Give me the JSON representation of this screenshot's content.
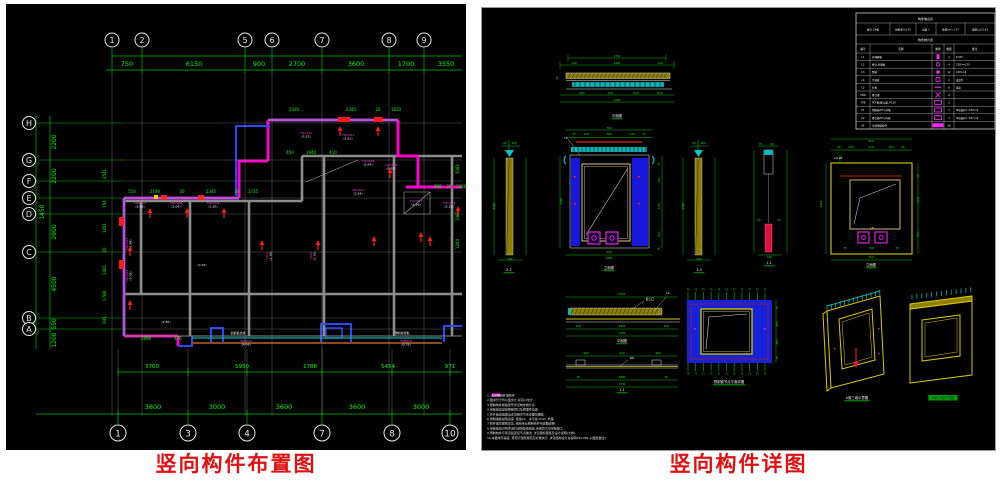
{
  "left": {
    "caption": "竖向构件布置图",
    "topGrid": [
      {
        "x": 106,
        "n": "1"
      },
      {
        "x": 136,
        "n": "2"
      },
      {
        "x": 239,
        "n": "5"
      },
      {
        "x": 266,
        "n": "6"
      },
      {
        "x": 316,
        "n": "7"
      },
      {
        "x": 383,
        "n": "8"
      },
      {
        "x": 418,
        "n": "9"
      }
    ],
    "topDims": [
      {
        "x": 121,
        "t": "750"
      },
      {
        "x": 188,
        "t": "6150"
      },
      {
        "x": 253,
        "t": "900"
      },
      {
        "x": 291,
        "t": "2700"
      },
      {
        "x": 350,
        "t": "3600"
      },
      {
        "x": 400,
        "t": "1700"
      },
      {
        "x": 440,
        "t": "3550"
      }
    ],
    "leftGrid": [
      {
        "y": 119,
        "n": "H"
      },
      {
        "y": 156,
        "n": "G"
      },
      {
        "y": 177,
        "n": "F"
      },
      {
        "y": 194,
        "n": "E"
      },
      {
        "y": 210,
        "n": "D"
      },
      {
        "y": 248,
        "n": "C"
      },
      {
        "y": 314,
        "n": "B"
      },
      {
        "y": 325,
        "n": "A"
      }
    ],
    "leftDims": [
      {
        "x": 50,
        "y": 138,
        "t": "2200"
      },
      {
        "x": 50,
        "y": 172,
        "t": "2200"
      },
      {
        "x": 50,
        "y": 228,
        "t": "2900"
      },
      {
        "x": 50,
        "y": 280,
        "t": "4500"
      },
      {
        "x": 50,
        "y": 320,
        "t": "550"
      },
      {
        "x": 50,
        "y": 336,
        "t": "1200"
      },
      {
        "x": 38,
        "y": 208,
        "t": "1450"
      }
    ],
    "botGrid": [
      {
        "x": 112,
        "n": "1"
      },
      {
        "x": 182,
        "n": "3"
      },
      {
        "x": 241,
        "n": "4"
      },
      {
        "x": 316,
        "n": "7"
      },
      {
        "x": 386,
        "n": "8"
      },
      {
        "x": 444,
        "n": "10"
      }
    ],
    "botDims": [
      {
        "x": 147,
        "t": "3600"
      },
      {
        "x": 211,
        "t": "3000"
      },
      {
        "x": 278,
        "t": "3600"
      },
      {
        "x": 351,
        "t": "3600"
      },
      {
        "x": 415,
        "t": "3000"
      }
    ],
    "midDims": [
      {
        "x": 146,
        "t": "3700"
      },
      {
        "x": 236,
        "t": "5950"
      },
      {
        "x": 304,
        "t": "1788"
      },
      {
        "x": 382,
        "t": "5454"
      },
      {
        "x": 444,
        "t": "971"
      }
    ],
    "planDims": [
      {
        "y": 189,
        "items": [
          {
            "x": 126,
            "t": "510"
          },
          {
            "x": 149,
            "t": "2190"
          },
          {
            "x": 176,
            "t": "20"
          },
          {
            "x": 205,
            "t": "2345"
          },
          {
            "x": 231,
            "t": "20"
          },
          {
            "x": 247,
            "t": "1735"
          }
        ]
      },
      {
        "y": 107,
        "items": [
          {
            "x": 288,
            "t": "2430"
          },
          {
            "x": 345,
            "t": "2340"
          },
          {
            "x": 372,
            "t": "20"
          },
          {
            "x": 390,
            "t": "1620"
          }
        ]
      },
      {
        "y": 150,
        "items": [
          {
            "x": 284,
            "t": "450"
          },
          {
            "x": 305,
            "t": "1940"
          },
          {
            "x": 327,
            "t": "410"
          }
        ]
      },
      {
        "y": 184,
        "items": [
          {
            "x": 432,
            "t": "988"
          },
          {
            "x": 443,
            "t": "20"
          },
          {
            "x": 455,
            "t": "2838"
          }
        ]
      },
      {
        "y": 336,
        "items": [
          {
            "x": 140,
            "t": "2898"
          },
          {
            "x": 172,
            "t": "470"
          }
        ]
      }
    ],
    "rotDims": [
      {
        "x": 100,
        "y": 170,
        "t": "2541"
      },
      {
        "x": 100,
        "y": 200,
        "t": "754"
      },
      {
        "x": 100,
        "y": 224,
        "t": "1451"
      },
      {
        "x": 100,
        "y": 246,
        "t": "20"
      },
      {
        "x": 100,
        "y": 266,
        "t": "1481"
      },
      {
        "x": 100,
        "y": 292,
        "t": "1788"
      },
      {
        "x": 100,
        "y": 316,
        "t": "941"
      },
      {
        "x": 453,
        "y": 165,
        "t": "3081"
      },
      {
        "x": 453,
        "y": 212,
        "t": "1981"
      },
      {
        "x": 453,
        "y": 240,
        "t": "1264"
      }
    ],
    "wallLabels": [
      {
        "x": 134,
        "y": 200,
        "c": "YWQ007",
        "v": "(1.49)"
      },
      {
        "x": 170,
        "y": 200,
        "c": "YWQ008",
        "v": "(1.04)"
      },
      {
        "x": 207,
        "y": 200,
        "c": "YWQ009",
        "v": "(1.30)"
      },
      {
        "x": 300,
        "y": 130,
        "c": "YWQ010",
        "v": "(3.37)"
      },
      {
        "x": 342,
        "y": 132,
        "c": "YWQ011",
        "v": "(1.81)"
      },
      {
        "x": 362,
        "y": 158,
        "c": "YWQ005",
        "v": "(0.54)"
      },
      {
        "x": 352,
        "y": 187,
        "c": "YWQ012",
        "v": "(2.54)"
      },
      {
        "x": 410,
        "y": 198,
        "c": "YWQ013",
        "v": "(1.29)"
      },
      {
        "x": 443,
        "y": 200,
        "c": "YWQ014",
        "v": "(2.15)"
      },
      {
        "x": 385,
        "y": 162,
        "c": "YWQ006",
        "v": "(0.92)"
      },
      {
        "x": 122,
        "y": 240,
        "c": "YWQ015",
        "v": "(1.98)",
        "r": 1
      },
      {
        "x": 122,
        "y": 272,
        "c": "YWQ016",
        "v": "(0.78)",
        "r": 1
      },
      {
        "x": 262,
        "y": 252,
        "c": "YQ01",
        "v": "(1.30)",
        "r": 1
      },
      {
        "x": 306,
        "y": 252,
        "c": "YQ02",
        "v": "(1.30)",
        "r": 1
      },
      {
        "x": 240,
        "y": 338,
        "c": "YWB001",
        "v": "(4.94)"
      },
      {
        "x": 400,
        "y": 338,
        "c": "YWB002",
        "v": "(0.79)"
      }
    ],
    "miscLabels": [
      {
        "x": 232,
        "y": 330,
        "t": "铝模板拉缝"
      },
      {
        "x": 396,
        "y": 330,
        "t": "预制拉缝板"
      },
      {
        "x": 160,
        "y": 319,
        "t": "(2.86)"
      },
      {
        "x": 196,
        "y": 262,
        "t": "(0.36)"
      }
    ]
  },
  "right": {
    "caption": "竖向构件详图",
    "tick": "75",
    "table": {
      "title": "构件信息表",
      "info": [
        "楼号 1#楼",
        "预制率(%) 25",
        "层数 1",
        "体积(m³) 2.37",
        "面积(㎡) 5.61"
      ],
      "subtitle": "构件统计表",
      "headers": [
        "编号",
        "名称",
        "图例",
        "数量",
        "备注"
      ],
      "rows": [
        {
          "c": "L1",
          "n": "外墙模板",
          "q": "2",
          "r": "b=63"
        },
        {
          "c": "L2",
          "n": "叠合,外墙板",
          "q": "4",
          "r": "C30 b=120"
        },
        {
          "c": "L3",
          "n": "飘窗",
          "q": "12",
          "r": "C30 L=6"
        },
        {
          "c": "L4",
          "n": "空调板",
          "q": "2",
          "r": "成品件"
        },
        {
          "c": "L5",
          "n": "栏板",
          "q": "6",
          "r": "成品"
        },
        {
          "c": "YWQ",
          "n": "叠合墙",
          "q": "8",
          "r": ""
        },
        {
          "c": "YTB",
          "n": "PCF板/叠合梁L=120",
          "q": "2",
          "r": ""
        },
        {
          "c": "F1",
          "n": "预制板(PC),外墙",
          "q": "1",
          "r": "单块面积= 4.02 m2"
        },
        {
          "c": "F2",
          "n": "叠合板(PC),内板",
          "q": "1",
          "r": "单块面积= 3.07 m2"
        },
        {
          "c": "AF",
          "n": "全部预制构件",
          "q": "26",
          "r": ""
        }
      ]
    },
    "detailCaptions": [
      {
        "x": 135,
        "y": 109,
        "t": "平面图"
      },
      {
        "x": 27,
        "y": 263,
        "t": "2-2"
      },
      {
        "x": 127,
        "y": 261,
        "t": "立面图"
      },
      {
        "x": 217,
        "y": 263,
        "t": "3-3"
      },
      {
        "x": 287,
        "y": 256,
        "t": "1-1"
      },
      {
        "x": 389,
        "y": 258,
        "t": "立面图"
      },
      {
        "x": 140,
        "y": 334,
        "t": "平面图"
      },
      {
        "x": 140,
        "y": 383,
        "t": "1-1"
      },
      {
        "x": 247,
        "y": 375,
        "t": "预制窗节点平面详图"
      },
      {
        "x": 375,
        "y": 391,
        "t": "A窗三维示意图",
        "u": true
      },
      {
        "x": 461,
        "y": 391,
        "t": "B窗三维示意图",
        "hl": true
      }
    ],
    "leaders": [
      {
        "x": 84,
        "y": 131,
        "t": "L5"
      },
      {
        "x": 390,
        "y": 221,
        "t": "L5"
      },
      {
        "x": 168,
        "y": 292,
        "t": "窗上口"
      },
      {
        "x": 186,
        "y": 286,
        "t": "L2"
      },
      {
        "x": 150,
        "y": 351,
        "t": "D8"
      },
      {
        "x": 356,
        "y": 151,
        "t": "+0.05"
      }
    ],
    "dimTexts": [
      {
        "x": 135,
        "y": 49,
        "t": "2730"
      },
      {
        "x": 92,
        "y": 56,
        "t": "140"
      },
      {
        "x": 135,
        "y": 56,
        "t": "2450"
      },
      {
        "x": 178,
        "y": 56,
        "t": "140"
      },
      {
        "x": 100,
        "y": 86,
        "t": "560"
      },
      {
        "x": 128,
        "y": 86,
        "t": "740"
      },
      {
        "x": 154,
        "y": 86,
        "t": "620"
      },
      {
        "x": 178,
        "y": 86,
        "t": "810"
      },
      {
        "x": 135,
        "y": 93,
        "t": "2730"
      },
      {
        "x": 76,
        "y": 70,
        "t": "90",
        "r": 1
      },
      {
        "x": 23,
        "y": 136,
        "t": "60"
      },
      {
        "x": 32,
        "y": 136,
        "t": "200"
      },
      {
        "x": 13,
        "y": 198,
        "t": "2980",
        "r": 1
      },
      {
        "x": 28,
        "y": 252,
        "t": "200"
      },
      {
        "x": 127,
        "y": 121,
        "t": "760"
      },
      {
        "x": 92,
        "y": 127,
        "t": "75"
      },
      {
        "x": 104,
        "y": 127,
        "t": "140"
      },
      {
        "x": 127,
        "y": 127,
        "t": "360"
      },
      {
        "x": 150,
        "y": 127,
        "t": "140"
      },
      {
        "x": 162,
        "y": 127,
        "t": "75"
      },
      {
        "x": 80,
        "y": 193,
        "t": "2980",
        "r": 1
      },
      {
        "x": 178,
        "y": 156,
        "t": "75",
        "r": 1
      },
      {
        "x": 178,
        "y": 172,
        "t": "560",
        "r": 1
      },
      {
        "x": 178,
        "y": 198,
        "t": "1240",
        "r": 1
      },
      {
        "x": 178,
        "y": 226,
        "t": "820",
        "r": 1
      },
      {
        "x": 178,
        "y": 241,
        "t": "75",
        "r": 1
      },
      {
        "x": 127,
        "y": 245,
        "t": "940"
      },
      {
        "x": 127,
        "y": 251,
        "t": "1060"
      },
      {
        "x": 212,
        "y": 136,
        "t": "60"
      },
      {
        "x": 221,
        "y": 136,
        "t": "200"
      },
      {
        "x": 202,
        "y": 198,
        "t": "2980",
        "r": 1
      },
      {
        "x": 217,
        "y": 252,
        "t": "200"
      },
      {
        "x": 278,
        "y": 137,
        "t": "75"
      },
      {
        "x": 290,
        "y": 137,
        "t": "90"
      },
      {
        "x": 277,
        "y": 213,
        "t": "60"
      },
      {
        "x": 297,
        "y": 213,
        "t": "25"
      },
      {
        "x": 287,
        "y": 250,
        "t": "140"
      },
      {
        "x": 389,
        "y": 134,
        "t": "910"
      },
      {
        "x": 357,
        "y": 140,
        "t": "85"
      },
      {
        "x": 369,
        "y": 140,
        "t": "165"
      },
      {
        "x": 389,
        "y": 140,
        "t": "210"
      },
      {
        "x": 409,
        "y": 140,
        "t": "165"
      },
      {
        "x": 421,
        "y": 140,
        "t": "85"
      },
      {
        "x": 340,
        "y": 196,
        "t": "2980",
        "r": 1
      },
      {
        "x": 437,
        "y": 168,
        "t": "75",
        "r": 1
      },
      {
        "x": 437,
        "y": 192,
        "t": "1240",
        "r": 1
      },
      {
        "x": 437,
        "y": 226,
        "t": "820",
        "r": 1
      },
      {
        "x": 363,
        "y": 241,
        "t": "75"
      },
      {
        "x": 389,
        "y": 241,
        "t": "740"
      },
      {
        "x": 415,
        "y": 241,
        "t": "75"
      },
      {
        "x": 389,
        "y": 250,
        "t": "910"
      },
      {
        "x": 140,
        "y": 287,
        "t": "2730"
      },
      {
        "x": 96,
        "y": 319,
        "t": "140"
      },
      {
        "x": 140,
        "y": 319,
        "t": "2450"
      },
      {
        "x": 184,
        "y": 319,
        "t": "140"
      },
      {
        "x": 140,
        "y": 326,
        "t": "2730"
      },
      {
        "x": 104,
        "y": 346,
        "t": "900"
      },
      {
        "x": 140,
        "y": 346,
        "t": "930"
      },
      {
        "x": 176,
        "y": 346,
        "t": "900"
      },
      {
        "x": 96,
        "y": 370,
        "t": "75"
      },
      {
        "x": 140,
        "y": 370,
        "t": "2580"
      },
      {
        "x": 184,
        "y": 370,
        "t": "75"
      },
      {
        "x": 140,
        "y": 377,
        "t": "2730"
      },
      {
        "x": 296,
        "y": 300,
        "t": "75",
        "r": 1
      },
      {
        "x": 296,
        "y": 316,
        "t": "450",
        "r": 1
      },
      {
        "x": 296,
        "y": 334,
        "t": "560",
        "r": 1
      },
      {
        "x": 296,
        "y": 350,
        "t": "75",
        "r": 1
      }
    ],
    "notes": [
      "1.         表示预制外墙构件.",
      "2.图中尺寸均以毫米计,标高以米计.",
      "3.预制构件规格型号详见构件统计表.",
      "4.吊装前应复核预留洞口及预埋件位置.",
      "5.外叶板接缝做法详见相关节点详图及图集.",
      "6.预制墙板拼缝宽度,  竖缝20、水平缝-0mm 处理.",
      "7.构件编号规则详见,  结构专业预制构件布置图说明.",
      "8.吊装前应对构件进行进场检查验收,合格后方可吊装施工.",
      "9.预制构件与现浇段连接节点做法,  详见国标图集及设计说明(大样).",
      "10.本图未尽事宜,  按现行国家规范及标准执行,  详见结构设计总说明15G365-1(图集做法)."
    ]
  }
}
